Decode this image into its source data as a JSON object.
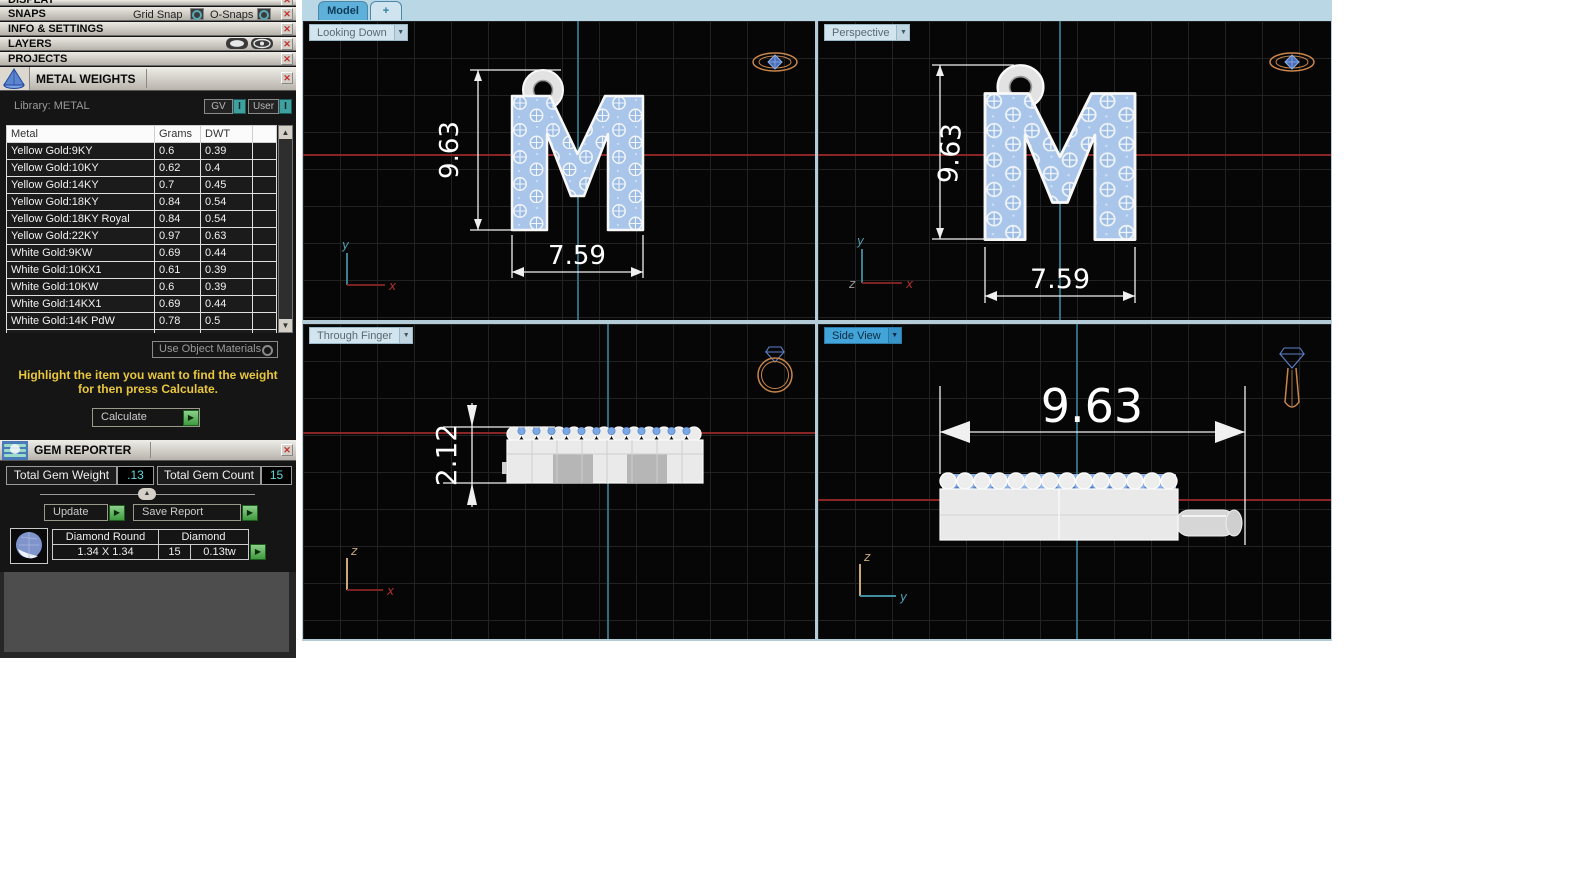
{
  "sidebar": {
    "display": {
      "title": "DISPLAY"
    },
    "snaps": {
      "title": "SNAPS",
      "grid_snap": "Grid Snap",
      "o_snaps": "O-Snaps"
    },
    "info_settings": {
      "title": "INFO & SETTINGS"
    },
    "layers": {
      "title": "LAYERS"
    },
    "projects": {
      "title": "PROJECTS"
    },
    "metal_weights": {
      "title": "METAL WEIGHTS",
      "library": "Library: METAL",
      "gv": "GV",
      "gv_value": "I",
      "user": "User",
      "user_value": "I",
      "table": {
        "headers": [
          "Metal",
          "Grams",
          "DWT"
        ],
        "rows": [
          [
            "Yellow Gold:9KY",
            "0.6",
            "0.39"
          ],
          [
            "Yellow Gold:10KY",
            "0.62",
            "0.4"
          ],
          [
            "Yellow Gold:14KY",
            "0.7",
            "0.45"
          ],
          [
            "Yellow Gold:18KY",
            "0.84",
            "0.54"
          ],
          [
            "Yellow Gold:18KY Royal",
            "0.84",
            "0.54"
          ],
          [
            "Yellow Gold:22KY",
            "0.97",
            "0.63"
          ],
          [
            "White Gold:9KW",
            "0.69",
            "0.44"
          ],
          [
            "White Gold:10KX1",
            "0.61",
            "0.39"
          ],
          [
            "White Gold:10KW",
            "0.6",
            "0.39"
          ],
          [
            "White Gold:14KX1",
            "0.69",
            "0.44"
          ],
          [
            "White Gold:14K PdW",
            "0.78",
            "0.5"
          ],
          [
            "White Gold:18KW",
            "0.81",
            "0.52"
          ]
        ]
      },
      "use_object_materials": "Use Object Materials",
      "hint_line1": "Highlight the item you want to find the weight",
      "hint_line2": "for then press Calculate.",
      "calculate": "Calculate"
    },
    "gem_reporter": {
      "title": "GEM REPORTER",
      "total_gem_weight_label": "Total Gem Weight",
      "total_gem_weight": ".13",
      "total_gem_count_label": "Total Gem Count",
      "total_gem_count": "15",
      "update": "Update",
      "save_report": "Save Report",
      "gem": {
        "cut": "Diamond Round",
        "material": "Diamond",
        "size": "1.34 X 1.34",
        "count": "15",
        "total_weight": "0.13tw"
      }
    }
  },
  "workspace": {
    "tabs": {
      "model": "Model",
      "add": "+"
    },
    "views": {
      "looking_down": {
        "label": "Looking Down",
        "dim_height": "9.63",
        "dim_width": "7.59",
        "axis_v": "y",
        "axis_h": "x"
      },
      "perspective": {
        "label": "Perspective",
        "dim_height": "9.63",
        "dim_width": "7.59",
        "axis_v": "y",
        "axis_h": "x",
        "axis_o": "z"
      },
      "through_finger": {
        "label": "Through Finger",
        "dim_thickness": "2.12",
        "axis_v": "z",
        "axis_h": "x"
      },
      "side_view": {
        "label": "Side View",
        "dim_length": "9.63",
        "axis_v": "z",
        "axis_h": "y"
      }
    }
  },
  "colors": {
    "accent_blue": "#58b0dc",
    "axis_teal": "#3e7f90",
    "axis_red": "#8a2525",
    "pave_blue": "#a9c6ea",
    "hint_yellow": "#e8c63e",
    "value_teal": "#5fd8d8",
    "button_green": "#58b058",
    "ring_gold": "#c8854c"
  }
}
